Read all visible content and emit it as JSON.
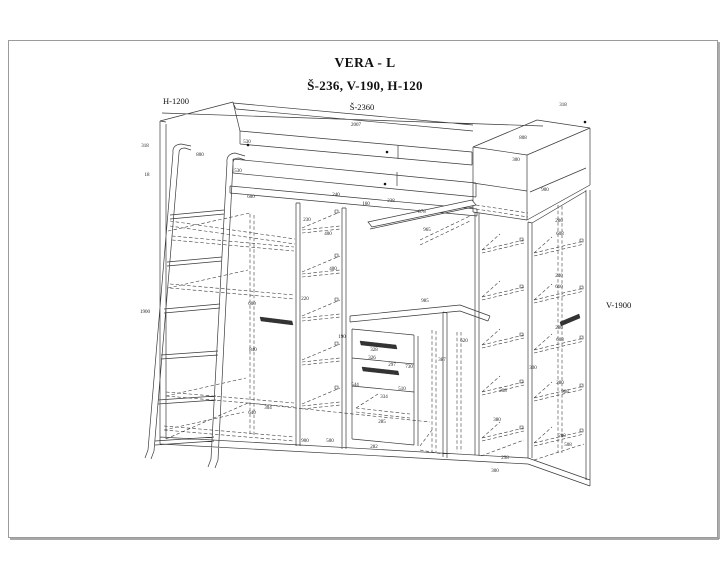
{
  "header": {
    "title": "VERA - L",
    "subtitle": "Š-236, V-190, H-120"
  },
  "dimension_labels": {
    "height": "H-1200",
    "width": "Š-2360",
    "side_height": "V-1900"
  },
  "colors": {
    "background": "#ffffff",
    "page_border": "#9b9b9b",
    "line": "#3a3a3a",
    "text": "#111111"
  },
  "small_dims": [
    {
      "t": "318",
      "x": 145,
      "y": 147
    },
    {
      "t": "18",
      "x": 147,
      "y": 176
    },
    {
      "t": "800",
      "x": 200,
      "y": 156
    },
    {
      "t": "530",
      "x": 247,
      "y": 143
    },
    {
      "t": "530",
      "x": 238,
      "y": 172
    },
    {
      "t": "600",
      "x": 251,
      "y": 198
    },
    {
      "t": "240",
      "x": 336,
      "y": 196
    },
    {
      "t": "160",
      "x": 366,
      "y": 205
    },
    {
      "t": "230",
      "x": 307,
      "y": 221
    },
    {
      "t": "400",
      "x": 328,
      "y": 235
    },
    {
      "t": "400",
      "x": 333,
      "y": 270
    },
    {
      "t": "1900",
      "x": 145,
      "y": 313
    },
    {
      "t": "220",
      "x": 305,
      "y": 300
    },
    {
      "t": "840",
      "x": 253,
      "y": 351
    },
    {
      "t": "600",
      "x": 252,
      "y": 305
    },
    {
      "t": "640",
      "x": 252,
      "y": 414
    },
    {
      "t": "900",
      "x": 305,
      "y": 442
    },
    {
      "t": "304",
      "x": 268,
      "y": 409
    },
    {
      "t": "500",
      "x": 330,
      "y": 442
    },
    {
      "t": "190",
      "x": 342,
      "y": 338
    },
    {
      "t": "328",
      "x": 374,
      "y": 351
    },
    {
      "t": "326",
      "x": 372,
      "y": 359
    },
    {
      "t": "297",
      "x": 392,
      "y": 366
    },
    {
      "t": "544",
      "x": 355,
      "y": 386
    },
    {
      "t": "730",
      "x": 409,
      "y": 368
    },
    {
      "t": "510",
      "x": 402,
      "y": 390
    },
    {
      "t": "334",
      "x": 384,
      "y": 398
    },
    {
      "t": "285",
      "x": 382,
      "y": 423
    },
    {
      "t": "282",
      "x": 374,
      "y": 448
    },
    {
      "t": "985",
      "x": 425,
      "y": 302
    },
    {
      "t": "965",
      "x": 427,
      "y": 231
    },
    {
      "t": "878",
      "x": 422,
      "y": 213
    },
    {
      "t": "238",
      "x": 391,
      "y": 202
    },
    {
      "t": "620",
      "x": 464,
      "y": 342
    },
    {
      "t": "2007",
      "x": 356,
      "y": 126
    },
    {
      "t": "318",
      "x": 563,
      "y": 106
    },
    {
      "t": "808",
      "x": 523,
      "y": 139
    },
    {
      "t": "300",
      "x": 516,
      "y": 161
    },
    {
      "t": "900",
      "x": 545,
      "y": 191
    },
    {
      "t": "280",
      "x": 559,
      "y": 222
    },
    {
      "t": "608",
      "x": 560,
      "y": 235
    },
    {
      "t": "240",
      "x": 559,
      "y": 277
    },
    {
      "t": "610",
      "x": 559,
      "y": 288
    },
    {
      "t": "280",
      "x": 559,
      "y": 329
    },
    {
      "t": "608",
      "x": 560,
      "y": 341
    },
    {
      "t": "387",
      "x": 442,
      "y": 361
    },
    {
      "t": "208",
      "x": 503,
      "y": 392
    },
    {
      "t": "380",
      "x": 497,
      "y": 421
    },
    {
      "t": "300",
      "x": 533,
      "y": 369
    },
    {
      "t": "280",
      "x": 560,
      "y": 384
    },
    {
      "t": "908",
      "x": 565,
      "y": 393
    },
    {
      "t": "298",
      "x": 505,
      "y": 459
    },
    {
      "t": "300",
      "x": 495,
      "y": 472
    },
    {
      "t": "280",
      "x": 562,
      "y": 437
    },
    {
      "t": "508",
      "x": 568,
      "y": 446
    }
  ]
}
